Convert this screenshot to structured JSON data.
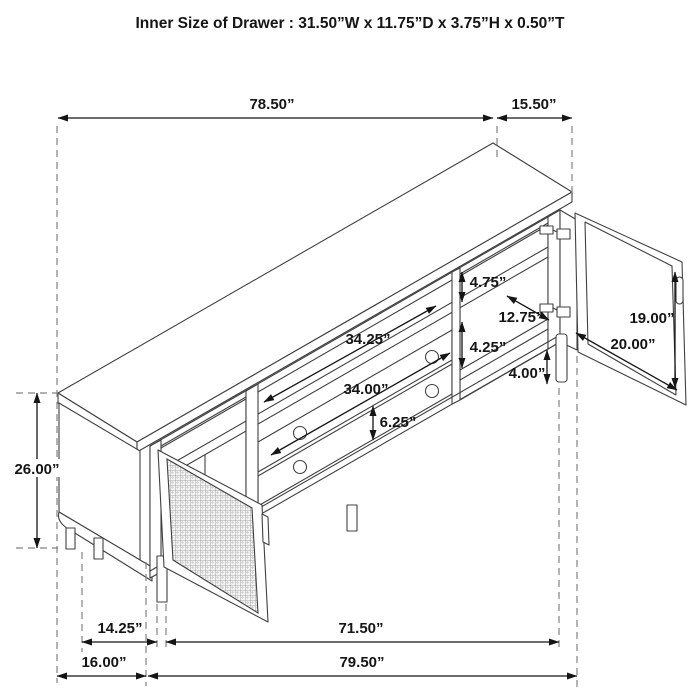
{
  "title": "Inner Size of Drawer : 31.50”W x 11.75”D x 3.75”H x 0.50”T",
  "diagram_type": "isometric furniture dimension drawing (TV console with drawers, cane mesh door and glass door)",
  "colors": {
    "dimension_text": "#151515",
    "furniture_line": "#404040",
    "extension_dash": "#828282",
    "background": "#ffffff"
  },
  "dims": {
    "overall_top": "78.50”",
    "right_top": "15.50”",
    "height": "26.00”",
    "left_inset": "14.25”",
    "left_end": "16.00”",
    "inner_bottom": "71.50”",
    "overall_bottom": "79.50”",
    "gap_top": "4.75”",
    "shelf_depth": "12.75”",
    "gap_mid": "4.25”",
    "leg_height": "4.00”",
    "door_height": "19.00”",
    "door_width": "20.00”",
    "opening_width": "34.25”",
    "drawer_width": "34.00”",
    "drawer_height": "6.25”"
  }
}
